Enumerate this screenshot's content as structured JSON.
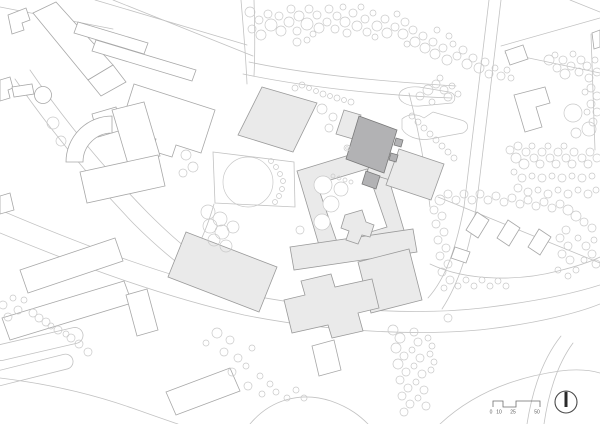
{
  "scalebar": {
    "labels": [
      "0",
      "10",
      "25",
      "50"
    ]
  },
  "north_arrow": {
    "icon": "north-arrow"
  },
  "colors": {
    "background": "#ffffff",
    "road_stroke": "#c2c2c2",
    "outline_stroke": "#a8a8a8",
    "tree_stroke": "#c9c9c9",
    "campus_fill": "#eaeaea",
    "campus_stroke": "#9a9a9a",
    "highlight_fill": "#b2b2b4",
    "highlight_stroke": "#7a7a7a",
    "scale_text": "#5d5d5d"
  }
}
